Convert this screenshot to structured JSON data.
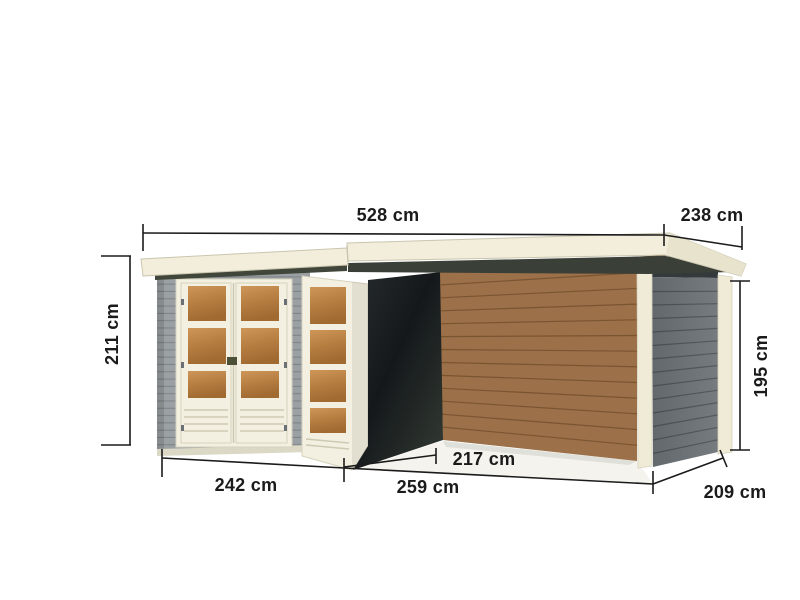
{
  "figure": {
    "type": "product-dimension-diagram",
    "subject": "flat-roof garden shed with side annex canopy",
    "unit": "cm"
  },
  "dimensions": {
    "overall_width": "528 cm",
    "overall_depth": "238 cm",
    "left_height": "211 cm",
    "right_height": "195 cm",
    "front_left_width": "242 cm",
    "front_right_width": "259 cm",
    "inner_depth": "217 cm",
    "right_depth": "209 cm"
  },
  "colors": {
    "background": "#ffffff",
    "roof_cream": "#f2eedb",
    "roof_side_cream": "#e7e3cd",
    "door_cream": "#f4f0e1",
    "wall_gray": "#9aa0a3",
    "end_wall_gray": "#6d7376",
    "shadow_dark": "#1a1f22",
    "wood_brown": "#9c7048",
    "window_amber": "#c08148",
    "floor_light": "#f4f3ed",
    "dimension_line": "#1b1b1b"
  }
}
